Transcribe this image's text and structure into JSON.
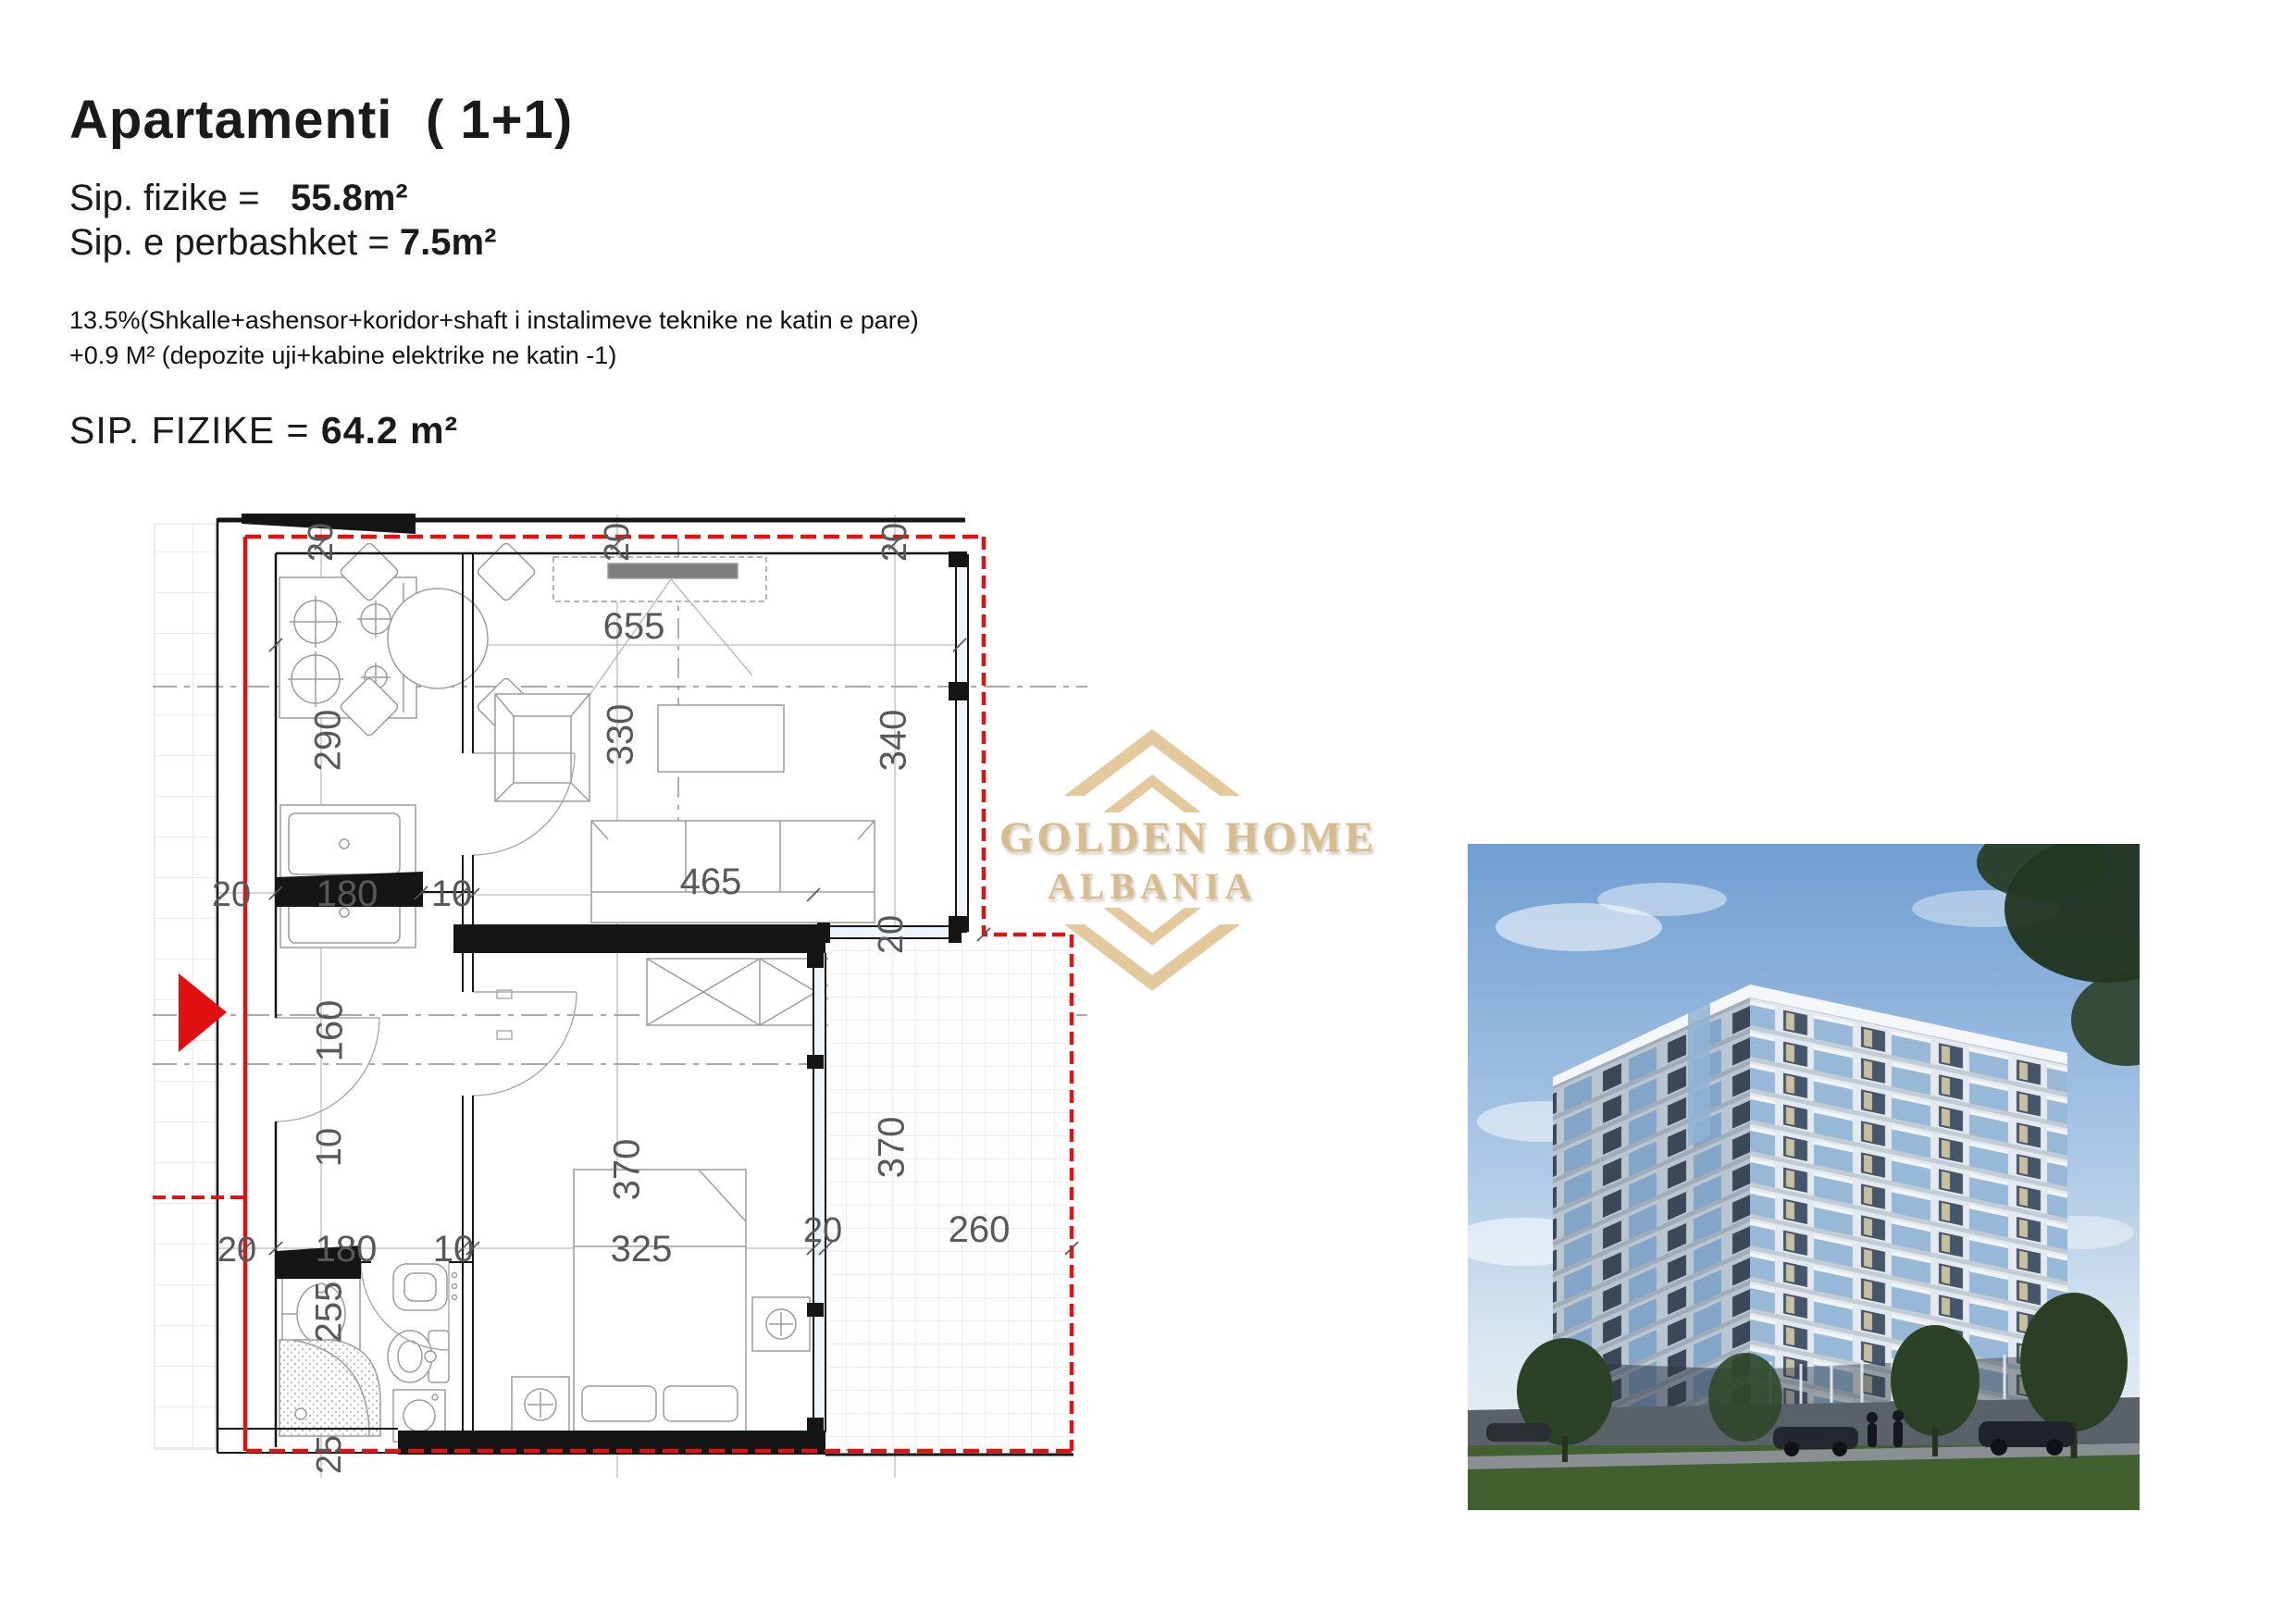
{
  "header": {
    "title": "Apartamenti",
    "apartment_type": "( 1+1)",
    "sip_fizike_label": "Sip. fizike =",
    "sip_fizike_value": "55.8m²",
    "sip_perbashket_label": "Sip. e perbashket =",
    "sip_perbashket_value": "7.5m²",
    "note_line1": "13.5%(Shkalle+ashensor+koridor+shaft i instalimeve teknike ne katin e pare)",
    "note_line2": "+0.9 M² (depozite uji+kabine elektrike ne katin -1)",
    "total_label": "SIP. FIZIKE =",
    "total_value": "64.2 m²"
  },
  "watermark": {
    "line1": "GOLDEN HOME",
    "line2": "ALBANIA",
    "gold_color": "#d9bc8e"
  },
  "floor_plan": {
    "boundary_color": "#dd1414",
    "dims": {
      "wall_top_left": "20",
      "wall_top_mid": "20",
      "wall_top_right": "20",
      "living_width": "655",
      "kitchen_depth": "290",
      "living_depth": "330",
      "window_living": "340",
      "hall_row_wall": "20",
      "hall_row_kitchen": "180",
      "hall_row_partition": "10",
      "sofa_width": "465",
      "window_jog": "20",
      "hall_height": "160",
      "partition_thickness": "10",
      "bedroom_depth": "370",
      "balcony_depth": "370",
      "bottom_wall_left": "20",
      "bottom_bath": "180",
      "bottom_partition": "10",
      "bottom_bedroom": "325",
      "bottom_window": "20",
      "bottom_balcony": "260",
      "bath_depth": "255",
      "bottom_wall_thickness": "25"
    }
  }
}
